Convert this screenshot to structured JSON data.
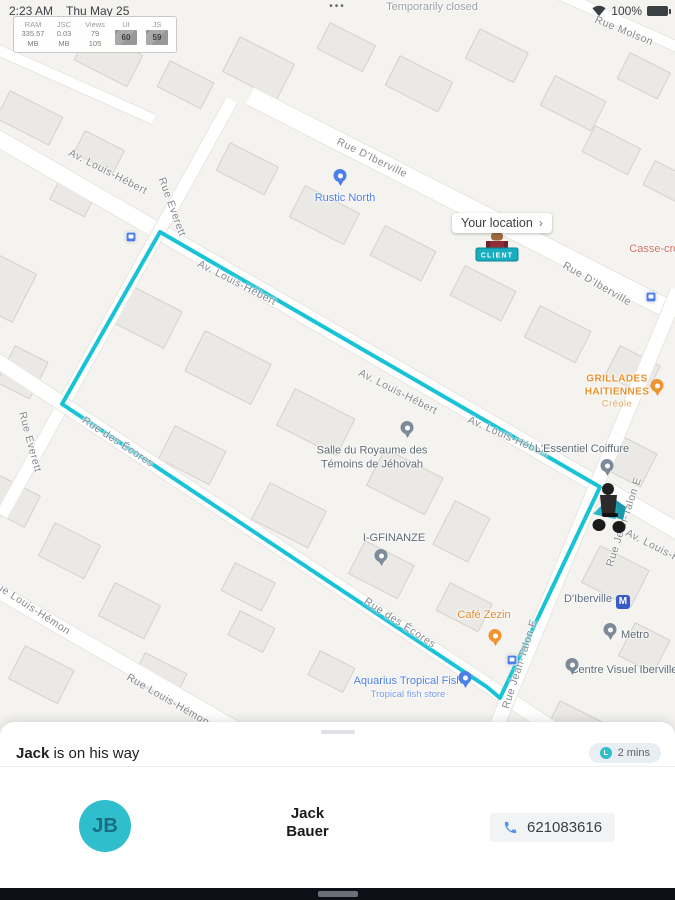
{
  "colors": {
    "accent": "#2fbecb",
    "route": "#19c3d6",
    "cancel": "#e2636b",
    "metro_blue": "#3a5bc7"
  },
  "status_bar": {
    "time": "2:23 AM",
    "date": "Thu May 25",
    "overflow": "•••",
    "battery_pct": "100%"
  },
  "perf_monitor": {
    "columns": [
      {
        "label": "RAM",
        "line1": "335.57",
        "line2": "MB",
        "boxed": false
      },
      {
        "label": "JSC",
        "line1": "0.03",
        "line2": "MB",
        "boxed": false
      },
      {
        "label": "Views",
        "line1": "79",
        "line2": "105",
        "boxed": false
      },
      {
        "label": "UI",
        "line1": "60",
        "line2": "",
        "boxed": true
      },
      {
        "label": "JS",
        "line1": "59",
        "line2": "",
        "boxed": true
      }
    ]
  },
  "map": {
    "route_color": "#19c3d6",
    "route_points": "160,232 62,404 487,687 500,698 600,487 160,232",
    "your_location": {
      "label": "Your location",
      "chevron": "›"
    },
    "client_tag": {
      "label": "CLIENT"
    },
    "streets": [
      {
        "label": "Av. Louis-Hébert",
        "x": 108,
        "y": 172,
        "rot": 27
      },
      {
        "label": "Rue D'Iberville",
        "x": 372,
        "y": 158,
        "rot": 26
      },
      {
        "label": "Rue Molson",
        "x": 624,
        "y": 31,
        "rot": 22
      },
      {
        "label": "Rue D'Iberville",
        "x": 597,
        "y": 284,
        "rot": 30
      },
      {
        "label": "Rue Everett",
        "x": 172,
        "y": 207,
        "rot": 70
      },
      {
        "label": "Rue Everett",
        "x": 30,
        "y": 442,
        "rot": 75
      },
      {
        "label": "Av. Louis-Hébert",
        "x": 237,
        "y": 283,
        "rot": 27
      },
      {
        "label": "Av. Louis-Hébert",
        "x": 398,
        "y": 392,
        "rot": 27
      },
      {
        "label": "Av. Louis-Hébert",
        "x": 508,
        "y": 437,
        "rot": 24
      },
      {
        "label": "Av. Louis-Hébert",
        "x": 665,
        "y": 552,
        "rot": 27
      },
      {
        "label": "Rue des Écores",
        "x": 118,
        "y": 442,
        "rot": 33
      },
      {
        "label": "Rue des Écores",
        "x": 400,
        "y": 623,
        "rot": 33
      },
      {
        "label": "Rue Jean-Talon E",
        "x": 624,
        "y": 522,
        "rot": -72
      },
      {
        "label": "Rue Jean-Talon E",
        "x": 520,
        "y": 664,
        "rot": -72
      },
      {
        "label": "Rue Louis-Hémon",
        "x": 30,
        "y": 607,
        "rot": 33
      },
      {
        "label": "Rue Louis-Hémon",
        "x": 168,
        "y": 700,
        "rot": 30
      }
    ],
    "pois": [
      {
        "label": "Temporarily closed",
        "x": 432,
        "y": 8,
        "color": "#9aa0a6"
      },
      {
        "label": "Rustic North",
        "x": 345,
        "y": 199,
        "color": "#4d7fe8",
        "pin": {
          "x": 340,
          "y": 188,
          "c": "#4d7fe8"
        }
      },
      {
        "label": "Casse-croûte",
        "x": 662,
        "y": 250,
        "color": "#cf6f62"
      },
      {
        "label": "GRILLADES",
        "label2": "HAITIENNES",
        "sub": "Créole",
        "x": 617,
        "y": 392,
        "color": "#e8912d",
        "caps": true,
        "pin": {
          "x": 657,
          "y": 398,
          "c": "#ef9433"
        }
      },
      {
        "label": "Salle du Royaume des",
        "label2": "Témoins de Jéhovah",
        "x": 372,
        "y": 458,
        "color": "#5f6b75",
        "pin": {
          "x": 407,
          "y": 440,
          "c": "#7c8a99"
        }
      },
      {
        "label": "L'Essentiel Coiffure",
        "x": 582,
        "y": 450,
        "color": "#5f6b75",
        "pin": {
          "x": 607,
          "y": 478,
          "c": "#7c8a99"
        }
      },
      {
        "label": "I-GFINANZE",
        "x": 394,
        "y": 539,
        "color": "#5f6b75",
        "pin": {
          "x": 381,
          "y": 568,
          "c": "#7c8a99"
        }
      },
      {
        "label": "Café Zezin",
        "x": 484,
        "y": 616,
        "color": "#de8a2c",
        "pin": {
          "x": 495,
          "y": 648,
          "c": "#ef9433"
        }
      },
      {
        "label": "D'Iberville",
        "x": 597,
        "y": 601,
        "color": "#5d6c86",
        "metro": true
      },
      {
        "label": "Metro",
        "x": 635,
        "y": 636,
        "color": "#5f6b75",
        "pin": {
          "x": 610,
          "y": 642,
          "c": "#7c8a99"
        }
      },
      {
        "label": "Centre Visuel Iberville",
        "x": 624,
        "y": 671,
        "color": "#5f6b75",
        "pin": {
          "x": 572,
          "y": 677,
          "c": "#7c8a99"
        }
      },
      {
        "label": "Aquarius Tropical Fish",
        "sub": "Tropical fish store",
        "x": 408,
        "y": 688,
        "color": "#4d7fe8",
        "pin": {
          "x": 465,
          "y": 690,
          "c": "#4d7fe8"
        }
      }
    ],
    "transit_stops": [
      {
        "x": 131,
        "y": 237
      },
      {
        "x": 651,
        "y": 297
      },
      {
        "x": 512,
        "y": 660
      }
    ],
    "metro_icon_label": "M"
  },
  "sheet": {
    "title_bold": "Jack",
    "title_rest": " is on his way",
    "eta": "2 mins",
    "driver": {
      "initials": "JB",
      "first": "Jack",
      "last": "Bauer",
      "phone": "621083616"
    },
    "cancel_label": "Cancel"
  }
}
